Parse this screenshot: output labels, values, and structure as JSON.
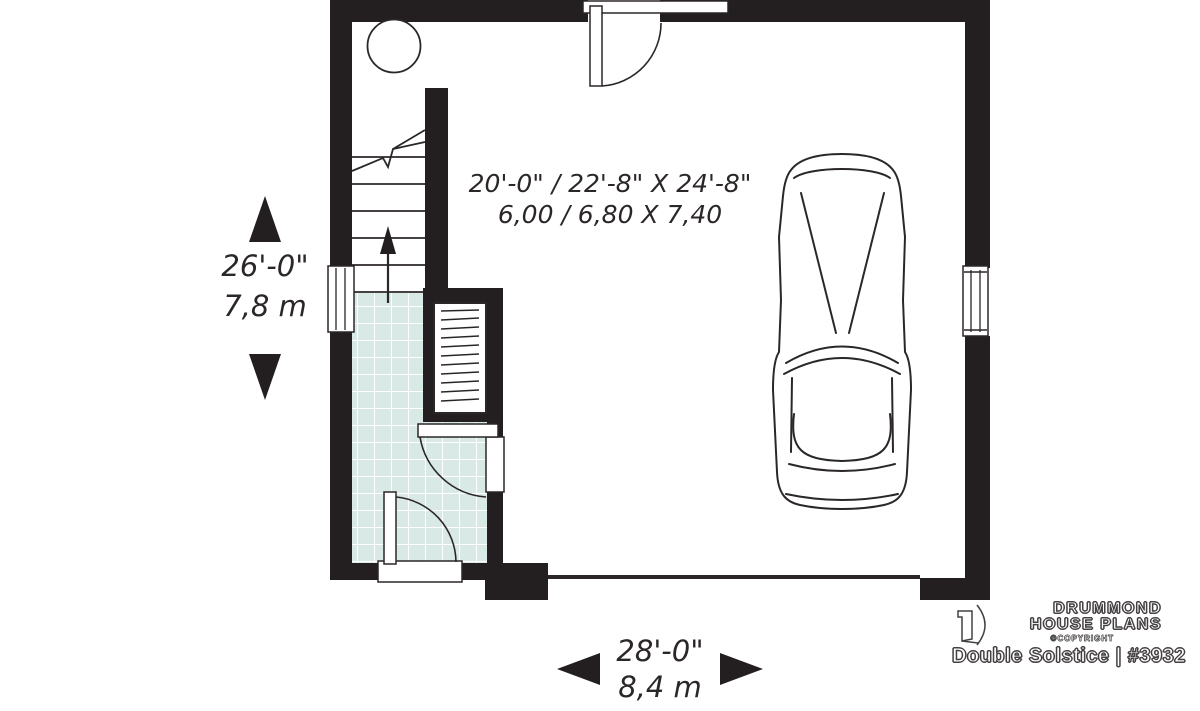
{
  "colors": {
    "wall": "#231f20",
    "line": "#2b2728",
    "tile": "#d9eae6",
    "tilegrid": "#ffffff",
    "text": "#2b2728"
  },
  "garage": {
    "dim_imperial": "20'-0\" / 22'-8\" X 24'-8\"",
    "dim_metric": "6,00 / 6,80 X 7,40"
  },
  "dimension_left": {
    "imperial": "26'-0\"",
    "metric": "7,8 m"
  },
  "dimension_bottom": {
    "imperial": "28'-0\"",
    "metric": "8,4 m"
  },
  "branding": {
    "name_line1": "DRUMMOND",
    "name_line2": "HOUSE PLANS",
    "copyright": "©COPYRIGHT",
    "plan_title": "Double Solstice | #3932"
  },
  "icons": {
    "dimension_up": "up-arrow-icon",
    "dimension_down": "down-arrow-icon",
    "dimension_left": "left-arrow-icon",
    "dimension_right": "right-arrow-icon",
    "stair_direction": "up-arrow-icon",
    "brand_mark": "drummond-d-icon"
  }
}
